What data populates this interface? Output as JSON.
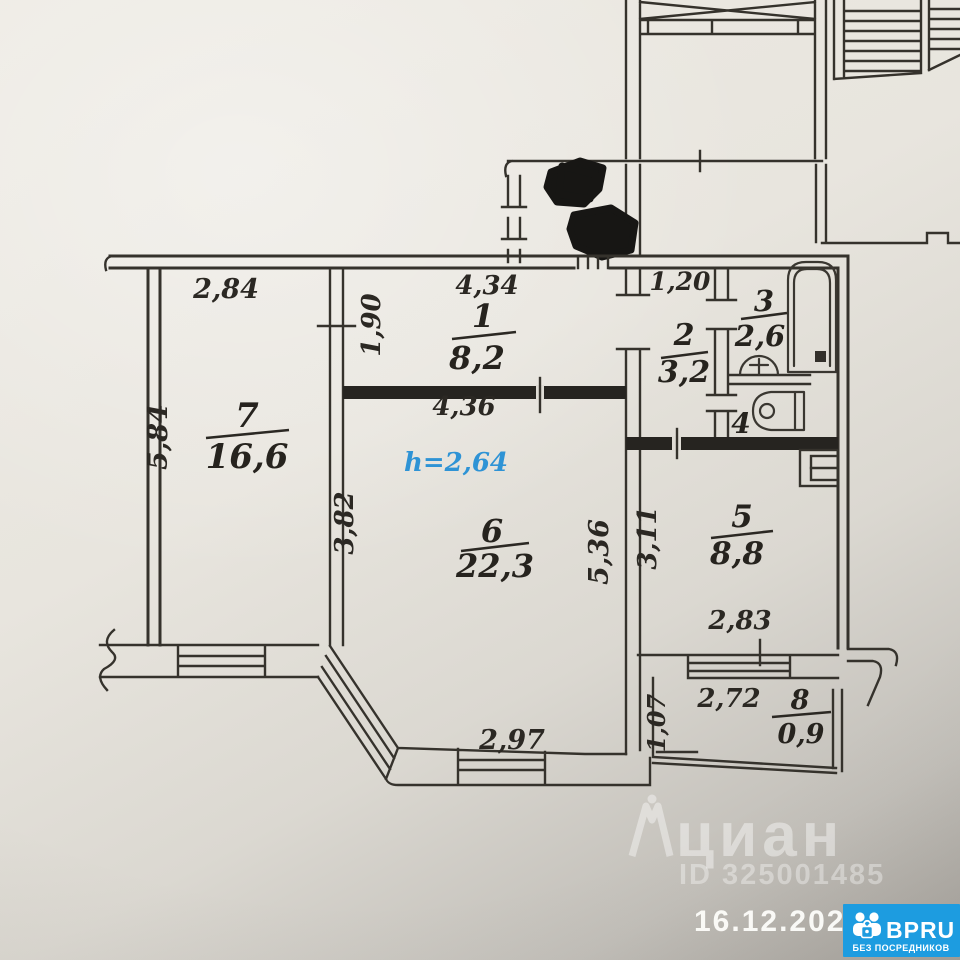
{
  "plan": {
    "ceiling_note": "h=2,64",
    "rooms": {
      "r1": {
        "num": "1",
        "area": "8,2"
      },
      "r2": {
        "num": "2",
        "area": "3,2"
      },
      "r3": {
        "num": "3",
        "area": "2,6"
      },
      "r4": {
        "num": "4",
        "area": ""
      },
      "r5": {
        "num": "5",
        "area": "8,8"
      },
      "r6": {
        "num": "6",
        "area": "22,3"
      },
      "r7": {
        "num": "7",
        "area": "16,6"
      },
      "r8": {
        "num": "8",
        "area": "0,9"
      }
    },
    "dims": {
      "room7_width": "2,84",
      "room7_depth": "5,84",
      "wall_upper": "1,90",
      "room1_width": "4,34",
      "room1_lower": "4,36",
      "room6_left": "3,82",
      "room6_right": "5,36",
      "room6_bay_bottom": "2,97",
      "hall_width": "1,20",
      "room5_left": "3,11",
      "room5_bottom": "2,83",
      "balcony_width": "2,72",
      "balcony_depth": "1,07"
    }
  },
  "watermark": {
    "brand": "циан",
    "listing_id": "ID 325001485"
  },
  "footer": {
    "date": "16.12.2025"
  },
  "badge": {
    "name": "BPRU",
    "tagline": "БЕЗ ПОСРЕДНИКОВ"
  },
  "colors": {
    "ink": "#32302c",
    "ceiling_note": "#2e93d5",
    "badge_bg": "#1d9ce0",
    "paper": "#e8e5de"
  }
}
